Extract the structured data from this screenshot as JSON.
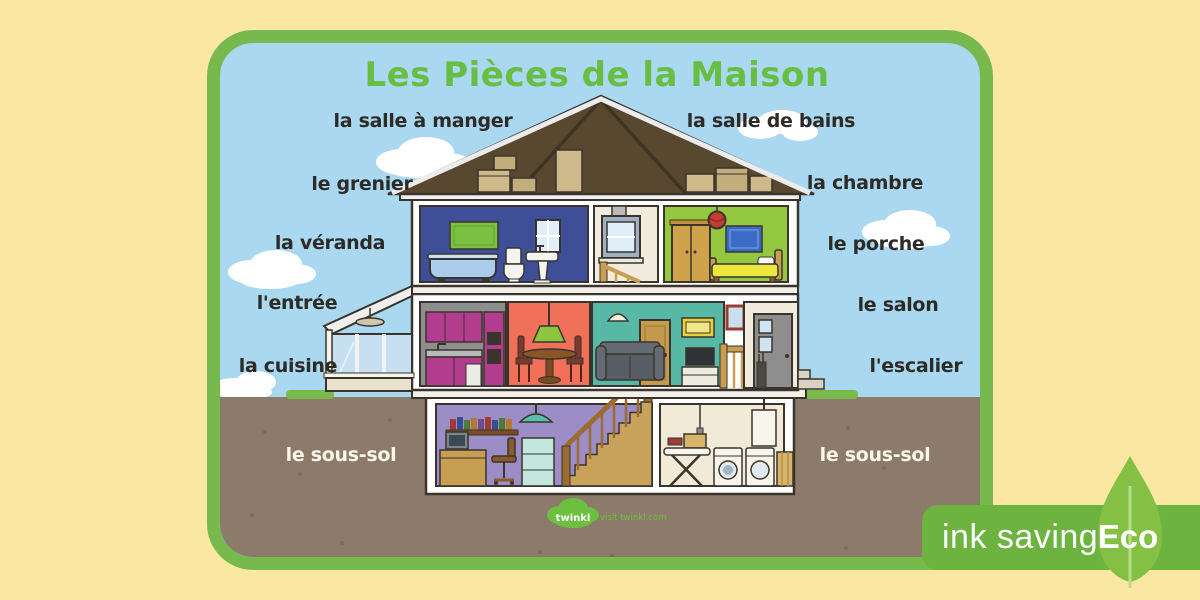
{
  "poster": {
    "title": "Les Pièces de la Maison",
    "labels": {
      "salle_a_manger": "la salle à manger",
      "salle_de_bains": "la salle de bains",
      "grenier": "le grenier",
      "chambre": "la chambre",
      "veranda": "la véranda",
      "porche": "le porche",
      "entree": "l'entrée",
      "salon": "le salon",
      "cuisine": "la cuisine",
      "escalier": "l'escalier",
      "sous_sol_left": "le sous-sol",
      "sous_sol_right": "le sous-sol"
    }
  },
  "badge": {
    "ink_saving": "ink saving",
    "eco": "Eco"
  },
  "footer": {
    "logo_text": "twinkl",
    "tagline": "visit twinkl.com"
  },
  "colors": {
    "background": "#FAE8A2",
    "card_border": "#77B94C",
    "title_green": "#68BE43",
    "sky": "#A9D8F0",
    "ground": "#8C7B6B",
    "grass": "#7AB94C",
    "label_dark": "#2E2A26",
    "label_light": "#FAF6EA",
    "roof": "#57482F",
    "bathroom": "#3F4F97",
    "landing": "#F1ECDD",
    "bedroom": "#94C840",
    "kitchen_wall": "#8E8E8E",
    "kitchen_cabinet": "#B23C8E",
    "dining": "#F0705A",
    "living": "#57B9A5",
    "basement_office": "#9C8DC6",
    "laundry": "#F0EAD6",
    "wood": "#C79E52",
    "badge_green": "#6CB33F",
    "leaf_green": "#83C044"
  }
}
